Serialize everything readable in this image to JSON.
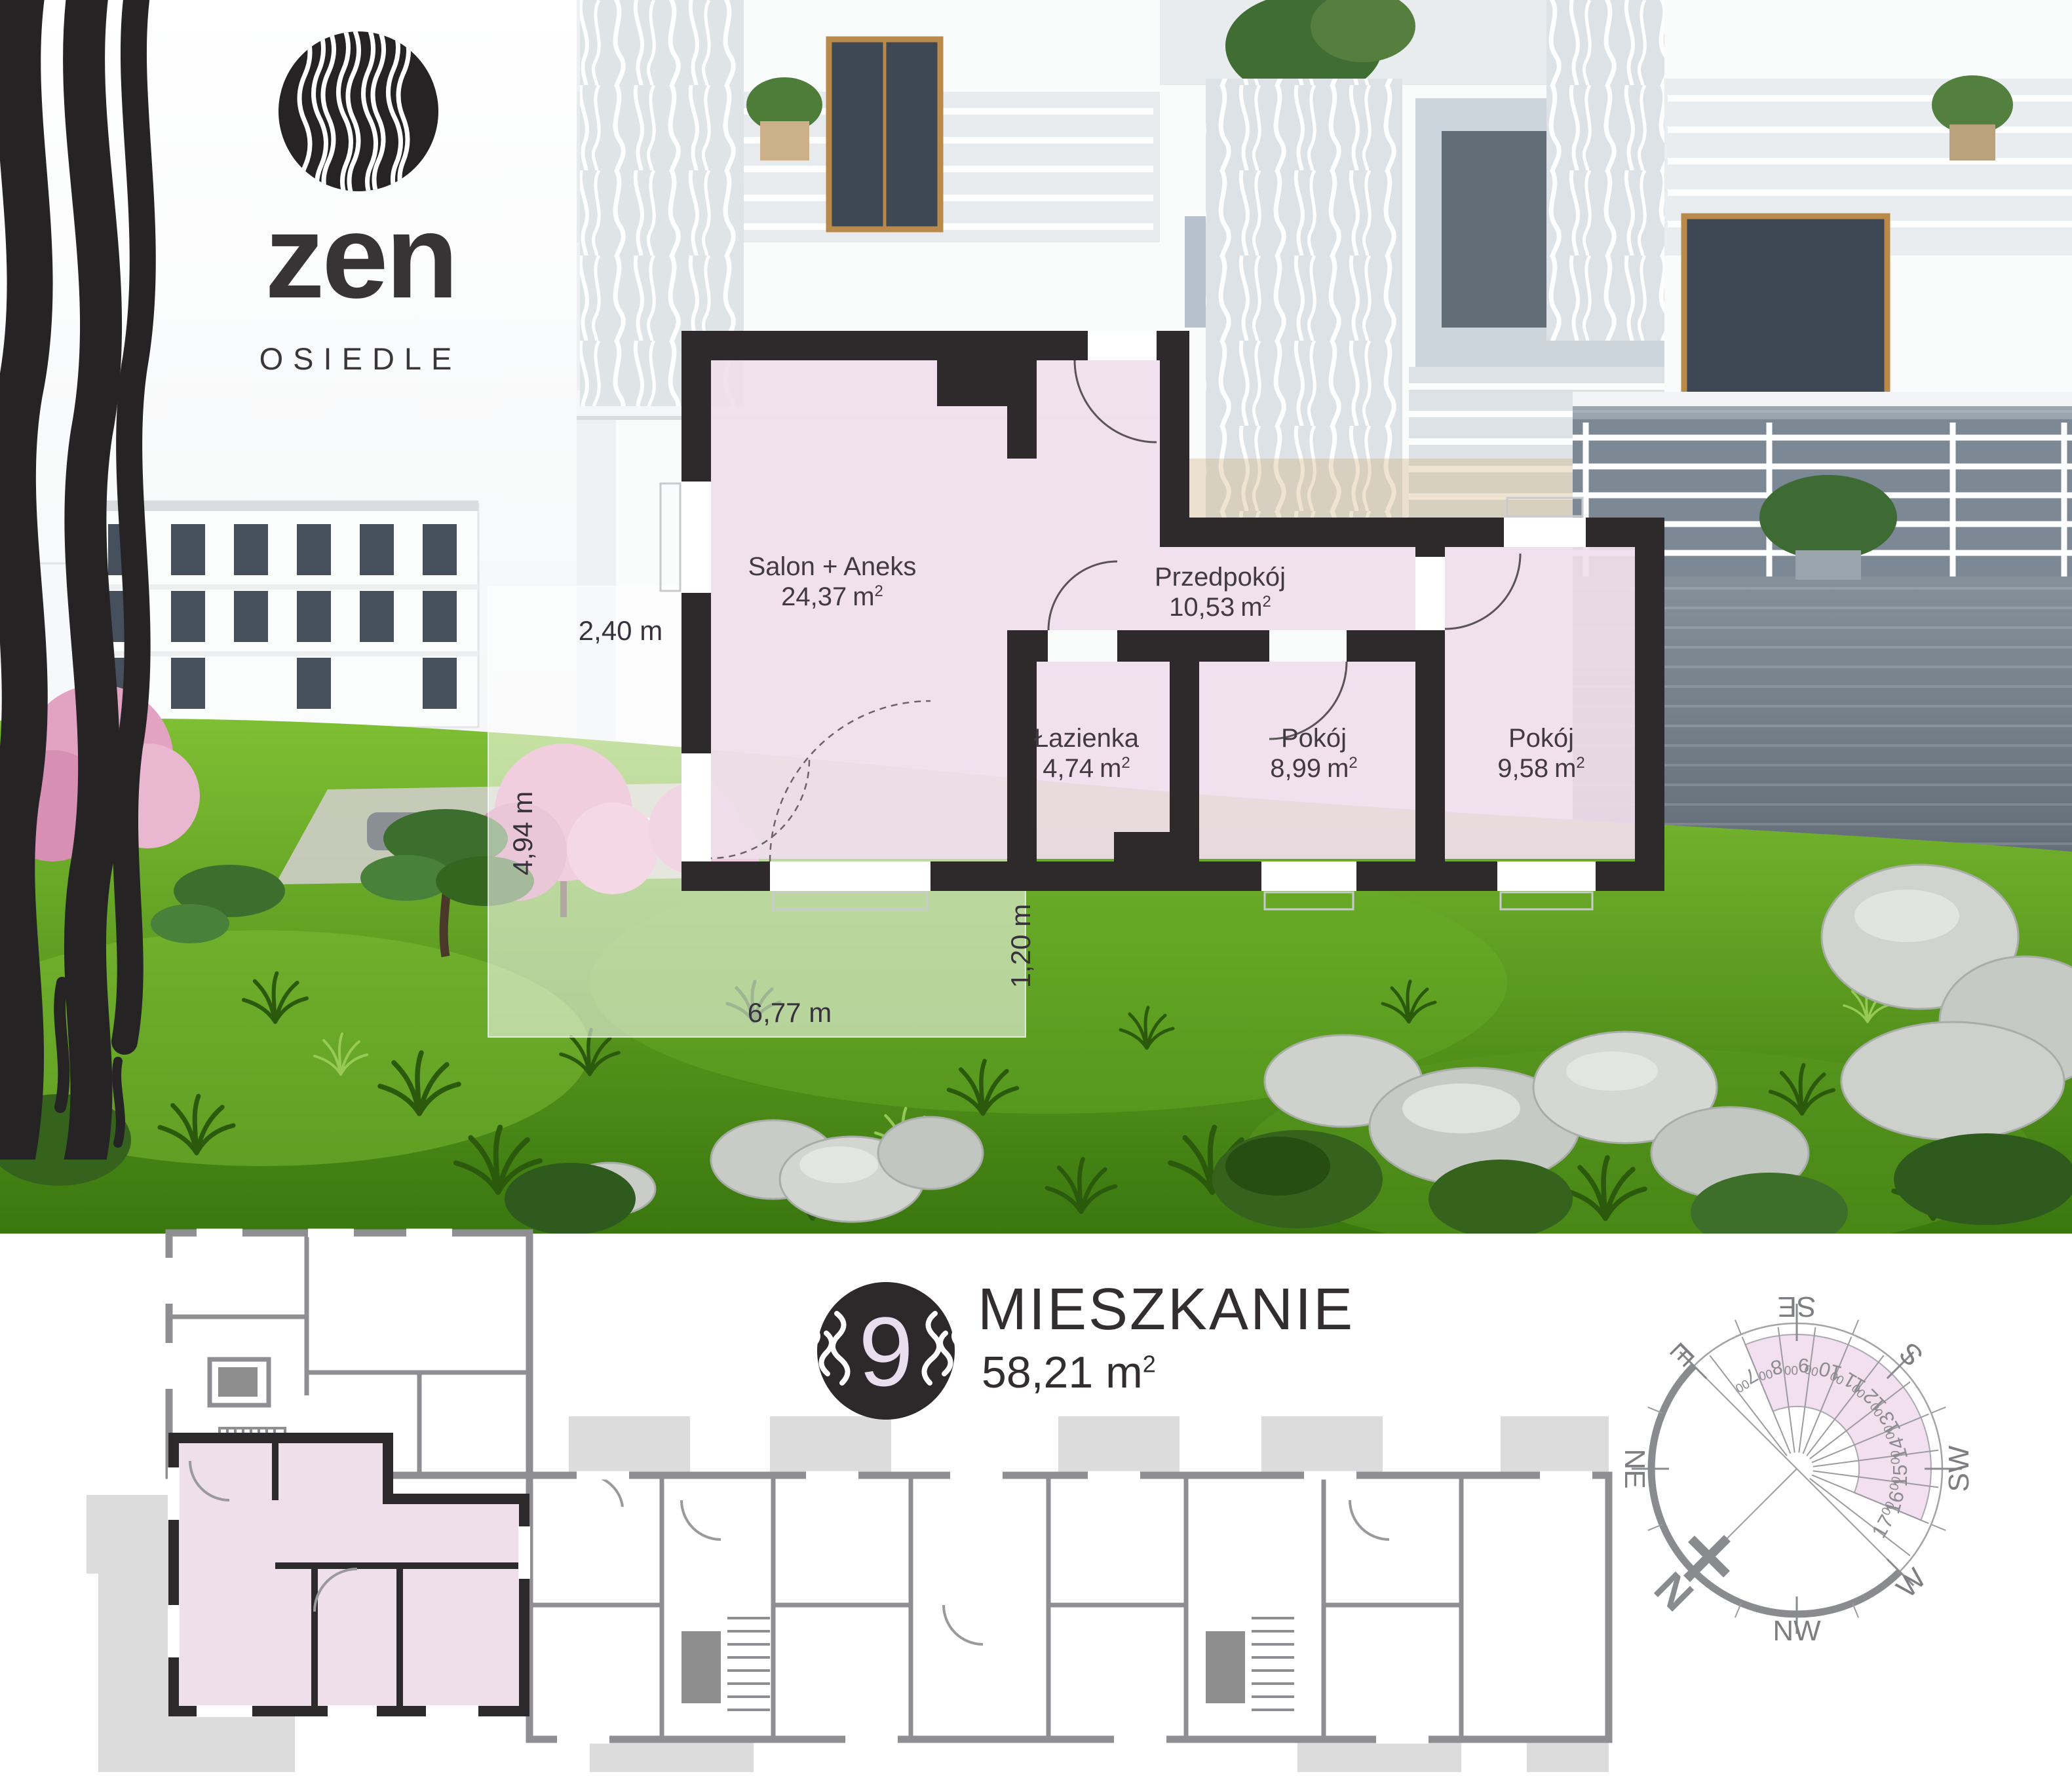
{
  "brand": {
    "name": "zen",
    "subtitle": "OSIEDLE"
  },
  "plan": {
    "rooms": [
      {
        "name": "Salon + Aneks",
        "area": "24,37"
      },
      {
        "name": "Przedpokój",
        "area": "10,53"
      },
      {
        "name": "Łazienka",
        "area": "4,74"
      },
      {
        "name": "Pokój",
        "area": "8,99"
      },
      {
        "name": "Pokój",
        "area": "9,58"
      }
    ],
    "area_unit": "m",
    "area_sup": "2",
    "dimensions": {
      "top": "2,40 m",
      "left": "4,94 m",
      "bottom": "6,77 m",
      "right": "1,20 m"
    }
  },
  "apartment": {
    "number": "9",
    "title": "MIESZKANIE",
    "area": "58,21"
  },
  "compass": {
    "cardinals": {
      "n": "N",
      "ne": "NE",
      "e": "E",
      "se": "SE",
      "s": "S",
      "sw": "SW",
      "w": "W",
      "nw": "NW"
    },
    "hours": [
      "7",
      "8",
      "9",
      "10",
      "11",
      "12",
      "13",
      "14",
      "15",
      "16",
      "17"
    ],
    "minutes": "00"
  },
  "colors": {
    "highlight_pink": "#f2e0ec",
    "wall_dark": "#2e2a2b",
    "plan_gray": "#8f8f93",
    "ring_gray": "#8a8b8f",
    "text_dark": "#38323c"
  }
}
